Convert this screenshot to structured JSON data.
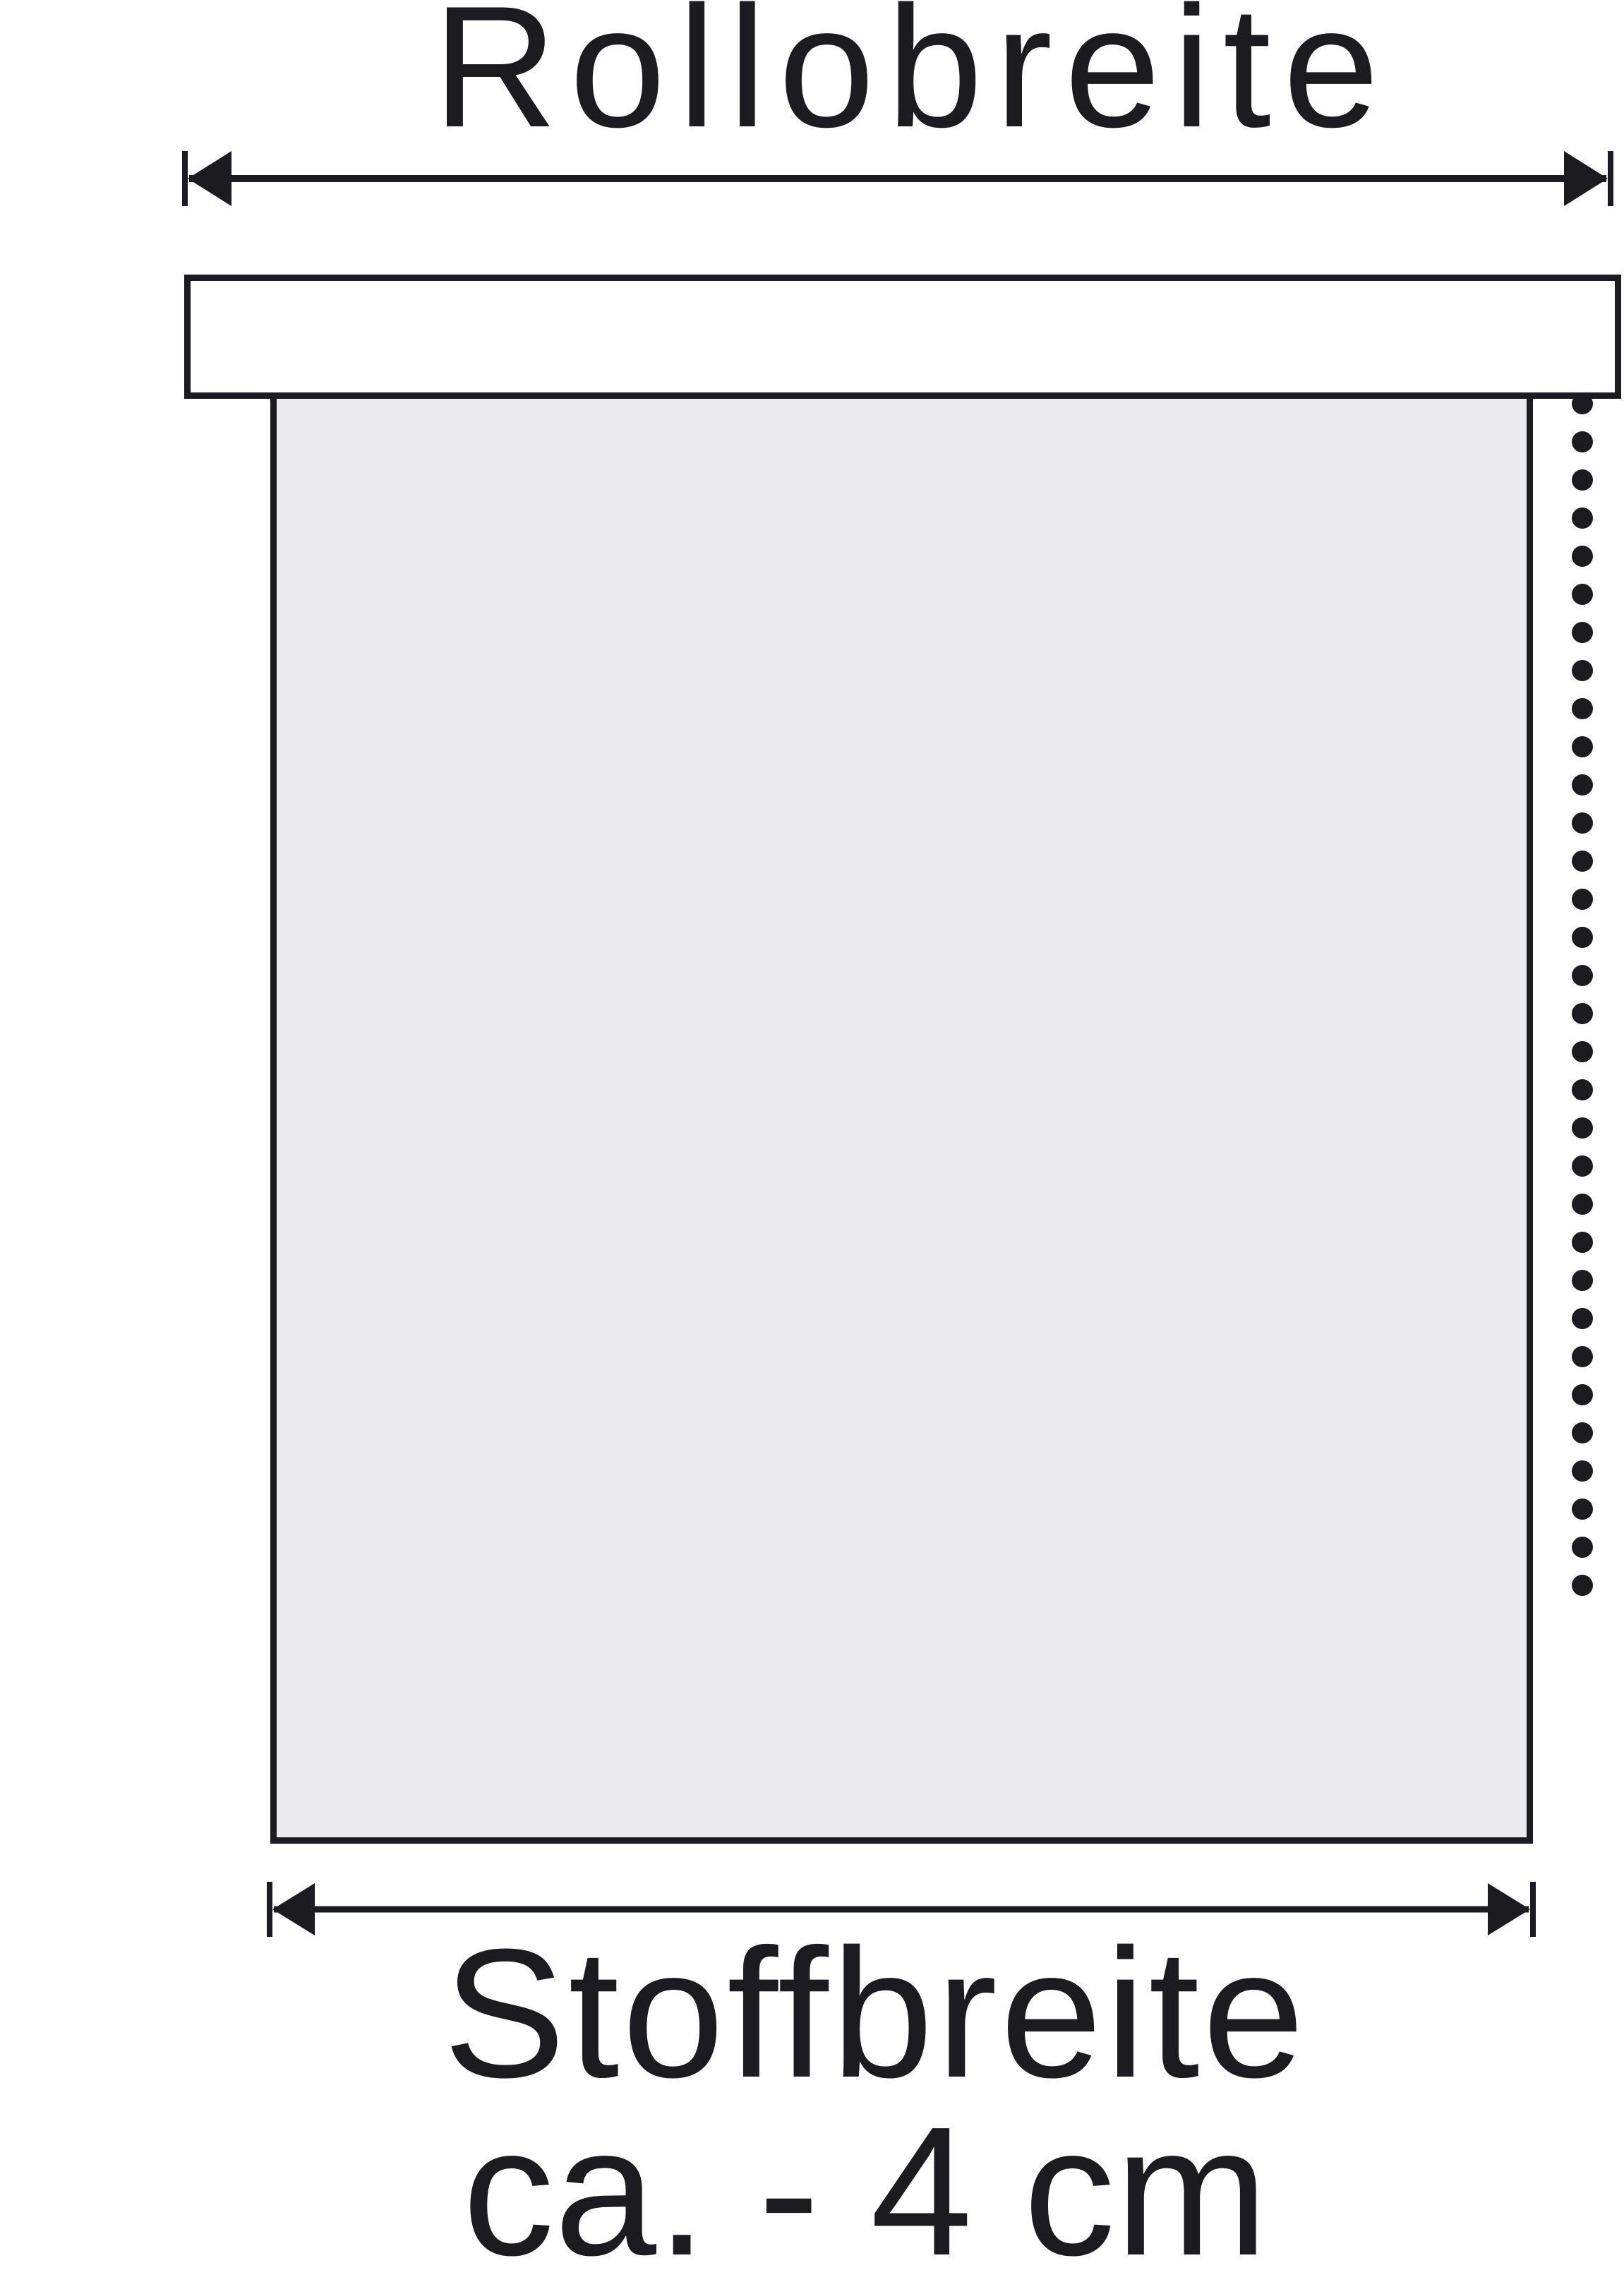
{
  "diagram": {
    "title": "Rollobreite",
    "fabric_label": {
      "line1": "Stoffbreite",
      "line2": "ca. - 4 cm"
    },
    "chain": {
      "dot_count": 32
    },
    "colors": {
      "ink": "#1b1b20",
      "fabric_fill": "#ebebed",
      "cassette_fill": "#ffffff",
      "background": "#ffffff"
    }
  }
}
